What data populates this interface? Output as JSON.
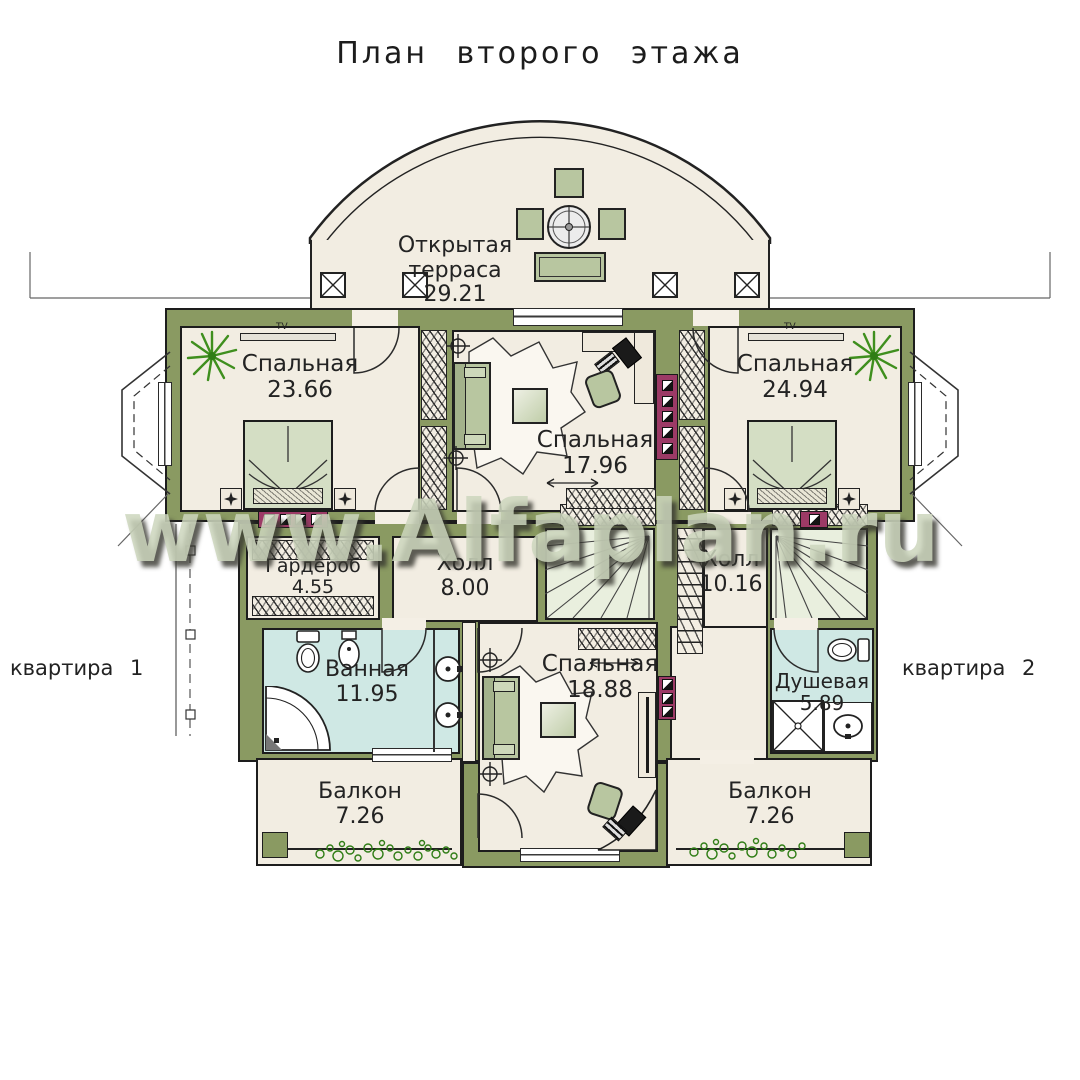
{
  "title": "План второго этажа",
  "watermark": "www.Alfaplan.ru",
  "labels": {
    "apartment1": "квартира 1",
    "apartment2": "квартира 2",
    "tv": "TV"
  },
  "rooms": {
    "terrace": {
      "label": "Открытая терраса",
      "area": "29.21"
    },
    "bedroom_left": {
      "label": "Спальная",
      "area": "23.66"
    },
    "bedroom_center_top": {
      "label": "Спальная",
      "area": "17.96"
    },
    "bedroom_right": {
      "label": "Спальная",
      "area": "24.94"
    },
    "wardrobe": {
      "label": "Гардероб",
      "area": "4.55"
    },
    "hall_left": {
      "label": "Холл",
      "area": "8.00"
    },
    "hall_right": {
      "label": "Холл",
      "area": "10.16"
    },
    "bathroom": {
      "label": "Ванная",
      "area": "11.95"
    },
    "bedroom_center_bottom": {
      "label": "Спальная",
      "area": "18.88"
    },
    "shower": {
      "label": "Душевая",
      "area": "5.89"
    },
    "balcony_left": {
      "label": "Балкон",
      "area": "7.26"
    },
    "balcony_right": {
      "label": "Балкон",
      "area": "7.26"
    }
  },
  "colors": {
    "wall_olive": "#8a9a62",
    "floor_cream": "#f2ede2",
    "wet_room_blue": "#cfe8e4",
    "furniture_green": "#b8c6a0",
    "chimney_magenta": "#9c3a66",
    "plant_green": "#3f8f1e",
    "line_dark": "#1d1d1d",
    "watermark_sage": "#cdd6bd"
  }
}
